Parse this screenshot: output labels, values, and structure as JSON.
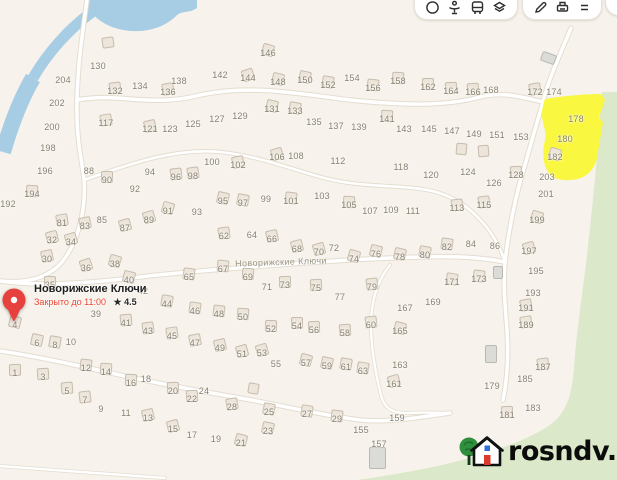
{
  "colors": {
    "bg": "#f7f3ec",
    "water": "#a6cde4",
    "forest": "#dbe8c9",
    "yellow": "#f9f73f",
    "road": "#ffffff",
    "road_casing": "#e4ddd0",
    "house_fill": "#ede5d9",
    "house_border": "#c6bcae",
    "gray_fill": "#dbdbd8",
    "gray_border": "#b9b9b4",
    "label": "#87806f",
    "street_label": "#9d9687",
    "pin": "#e7413e",
    "status": "#ee4330",
    "icon": "#2e2e2e"
  },
  "toolbar": {
    "groups": [
      {
        "buttons": [
          {
            "icon": "traffic"
          },
          {
            "icon": "pedestrian"
          },
          {
            "icon": "bus"
          },
          {
            "icon": "layers"
          }
        ]
      },
      {
        "buttons": [
          {
            "icon": "measure"
          },
          {
            "icon": "print"
          },
          {
            "icon": "menu"
          }
        ]
      }
    ]
  },
  "place_popup": {
    "title": "Новорижские Ключи",
    "status": "Закрыто до 11:00",
    "rating_star": "★",
    "rating": "4.5"
  },
  "street_label": "Новорижские Ключи",
  "watermark": {
    "text": "rosndv.ru"
  },
  "highlighted_plots": [
    178,
    180,
    182
  ],
  "plots": {
    "format": "[plot_number, x, y, has_house]",
    "items": [
      [
        130,
        98,
        66,
        0
      ],
      [
        204,
        63,
        80,
        0
      ],
      [
        202,
        57,
        103,
        0
      ],
      [
        200,
        52,
        127,
        0
      ],
      [
        198,
        48,
        148,
        0
      ],
      [
        196,
        45,
        171,
        0
      ],
      [
        194,
        32,
        194,
        1
      ],
      [
        192,
        8,
        204,
        0
      ],
      [
        132,
        115,
        91,
        1
      ],
      [
        134,
        140,
        86,
        0
      ],
      [
        136,
        168,
        92,
        1
      ],
      [
        138,
        179,
        81,
        0
      ],
      [
        117,
        106,
        123,
        1
      ],
      [
        121,
        150,
        129,
        1
      ],
      [
        123,
        170,
        129,
        0
      ],
      [
        125,
        193,
        124,
        0
      ],
      [
        88,
        89,
        171,
        0
      ],
      [
        90,
        107,
        180,
        1
      ],
      [
        92,
        135,
        189,
        0
      ],
      [
        94,
        150,
        172,
        0
      ],
      [
        96,
        176,
        177,
        1
      ],
      [
        98,
        193,
        176,
        1
      ],
      [
        146,
        268,
        53,
        1
      ],
      [
        142,
        220,
        75,
        0
      ],
      [
        144,
        248,
        78,
        1
      ],
      [
        148,
        278,
        82,
        1
      ],
      [
        150,
        305,
        80,
        1
      ],
      [
        152,
        328,
        85,
        1
      ],
      [
        154,
        352,
        78,
        0
      ],
      [
        156,
        373,
        88,
        1
      ],
      [
        158,
        398,
        81,
        1
      ],
      [
        162,
        428,
        87,
        1
      ],
      [
        164,
        451,
        91,
        1
      ],
      [
        166,
        473,
        92,
        1
      ],
      [
        168,
        491,
        90,
        0
      ],
      [
        172,
        535,
        92,
        1
      ],
      [
        174,
        554,
        92,
        0
      ],
      [
        127,
        217,
        119,
        0
      ],
      [
        129,
        240,
        116,
        0
      ],
      [
        131,
        272,
        109,
        1
      ],
      [
        133,
        295,
        111,
        1
      ],
      [
        135,
        314,
        122,
        0
      ],
      [
        137,
        336,
        126,
        0
      ],
      [
        139,
        359,
        127,
        0
      ],
      [
        141,
        387,
        119,
        1
      ],
      [
        143,
        404,
        129,
        0
      ],
      [
        145,
        429,
        129,
        0
      ],
      [
        147,
        452,
        131,
        0
      ],
      [
        149,
        474,
        134,
        0
      ],
      [
        151,
        497,
        135,
        0
      ],
      [
        153,
        521,
        137,
        0
      ],
      [
        100,
        212,
        162,
        0
      ],
      [
        102,
        238,
        165,
        1
      ],
      [
        106,
        277,
        157,
        1
      ],
      [
        108,
        296,
        156,
        0
      ],
      [
        112,
        338,
        161,
        0
      ],
      [
        118,
        401,
        167,
        0
      ],
      [
        120,
        431,
        175,
        0
      ],
      [
        124,
        468,
        172,
        0
      ],
      [
        126,
        494,
        183,
        0
      ],
      [
        128,
        516,
        175,
        1
      ],
      [
        203,
        547,
        177,
        0
      ],
      [
        178,
        576,
        119,
        0
      ],
      [
        180,
        565,
        139,
        0
      ],
      [
        182,
        555,
        157,
        1
      ],
      [
        201,
        546,
        194,
        0
      ],
      [
        199,
        537,
        220,
        1
      ],
      [
        197,
        529,
        251,
        1
      ],
      [
        195,
        536,
        271,
        0
      ],
      [
        193,
        533,
        293,
        0
      ],
      [
        191,
        526,
        308,
        1
      ],
      [
        189,
        526,
        325,
        1
      ],
      [
        111,
        413,
        211,
        0
      ],
      [
        113,
        457,
        208,
        1
      ],
      [
        115,
        484,
        205,
        1
      ],
      [
        80,
        425,
        255,
        1
      ],
      [
        82,
        447,
        247,
        1
      ],
      [
        84,
        471,
        244,
        0
      ],
      [
        86,
        495,
        246,
        0
      ],
      [
        171,
        452,
        282,
        1
      ],
      [
        173,
        479,
        279,
        1
      ],
      [
        169,
        433,
        302,
        0
      ],
      [
        167,
        405,
        308,
        0
      ],
      [
        165,
        400,
        331,
        1
      ],
      [
        163,
        400,
        365,
        0
      ],
      [
        161,
        394,
        384,
        1
      ],
      [
        159,
        397,
        418,
        0
      ],
      [
        155,
        361,
        430,
        0
      ],
      [
        157,
        379,
        444,
        0
      ],
      [
        185,
        525,
        379,
        0
      ],
      [
        187,
        543,
        367,
        1
      ],
      [
        183,
        533,
        408,
        0
      ],
      [
        181,
        507,
        415,
        1
      ],
      [
        179,
        492,
        386,
        0
      ],
      [
        95,
        223,
        201,
        1
      ],
      [
        97,
        243,
        203,
        1
      ],
      [
        99,
        266,
        199,
        0
      ],
      [
        101,
        291,
        201,
        1
      ],
      [
        103,
        322,
        196,
        0
      ],
      [
        105,
        349,
        205,
        1
      ],
      [
        107,
        370,
        211,
        0
      ],
      [
        109,
        391,
        210,
        0
      ],
      [
        62,
        224,
        236,
        1
      ],
      [
        64,
        252,
        235,
        0
      ],
      [
        66,
        272,
        239,
        1
      ],
      [
        68,
        297,
        249,
        1
      ],
      [
        70,
        319,
        252,
        1
      ],
      [
        72,
        334,
        248,
        0
      ],
      [
        74,
        354,
        259,
        1
      ],
      [
        76,
        376,
        254,
        1
      ],
      [
        78,
        400,
        257,
        1
      ],
      [
        67,
        223,
        269,
        1
      ],
      [
        69,
        248,
        277,
        1
      ],
      [
        71,
        267,
        287,
        0
      ],
      [
        73,
        285,
        285,
        1
      ],
      [
        75,
        316,
        288,
        1
      ],
      [
        77,
        340,
        297,
        0
      ],
      [
        79,
        372,
        287,
        1
      ],
      [
        81,
        62,
        223,
        1
      ],
      [
        83,
        85,
        226,
        1
      ],
      [
        85,
        102,
        220,
        0
      ],
      [
        87,
        125,
        228,
        1
      ],
      [
        89,
        149,
        220,
        1
      ],
      [
        91,
        168,
        211,
        1
      ],
      [
        93,
        197,
        212,
        0
      ],
      [
        32,
        52,
        240,
        1
      ],
      [
        34,
        71,
        242,
        1
      ],
      [
        30,
        47,
        259,
        1
      ],
      [
        36,
        86,
        268,
        1
      ],
      [
        38,
        115,
        264,
        1
      ],
      [
        40,
        129,
        280,
        1
      ],
      [
        42,
        143,
        291,
        0
      ],
      [
        44,
        167,
        304,
        1
      ],
      [
        46,
        195,
        311,
        1
      ],
      [
        65,
        189,
        277,
        1
      ],
      [
        35,
        50,
        285,
        1
      ],
      [
        39,
        96,
        314,
        0
      ],
      [
        41,
        126,
        323,
        1
      ],
      [
        43,
        148,
        331,
        1
      ],
      [
        45,
        172,
        336,
        1
      ],
      [
        47,
        195,
        343,
        1
      ],
      [
        48,
        219,
        314,
        1
      ],
      [
        50,
        243,
        317,
        1
      ],
      [
        52,
        271,
        329,
        1
      ],
      [
        54,
        297,
        326,
        1
      ],
      [
        56,
        314,
        330,
        1
      ],
      [
        58,
        345,
        333,
        1
      ],
      [
        60,
        371,
        325,
        1
      ],
      [
        49,
        220,
        348,
        1
      ],
      [
        51,
        242,
        354,
        1
      ],
      [
        53,
        262,
        353,
        1
      ],
      [
        55,
        276,
        364,
        0
      ],
      [
        57,
        306,
        363,
        1
      ],
      [
        59,
        327,
        366,
        1
      ],
      [
        61,
        346,
        367,
        1
      ],
      [
        63,
        363,
        371,
        1
      ],
      [
        4,
        15,
        325,
        1
      ],
      [
        6,
        37,
        343,
        1
      ],
      [
        8,
        55,
        345,
        1
      ],
      [
        10,
        71,
        342,
        0
      ],
      [
        1,
        15,
        373,
        1
      ],
      [
        3,
        43,
        377,
        1
      ],
      [
        5,
        67,
        391,
        1
      ],
      [
        7,
        85,
        400,
        1
      ],
      [
        9,
        101,
        409,
        0
      ],
      [
        11,
        126,
        413,
        0
      ],
      [
        12,
        86,
        368,
        1
      ],
      [
        14,
        106,
        372,
        1
      ],
      [
        16,
        131,
        383,
        1
      ],
      [
        18,
        146,
        379,
        0
      ],
      [
        20,
        173,
        391,
        1
      ],
      [
        22,
        192,
        399,
        1
      ],
      [
        24,
        204,
        391,
        0
      ],
      [
        13,
        148,
        418,
        1
      ],
      [
        15,
        173,
        429,
        1
      ],
      [
        17,
        192,
        435,
        0
      ],
      [
        19,
        216,
        439,
        0
      ],
      [
        21,
        241,
        443,
        1
      ],
      [
        23,
        268,
        431,
        1
      ],
      [
        25,
        269,
        412,
        1
      ],
      [
        27,
        307,
        414,
        1
      ],
      [
        29,
        337,
        419,
        1
      ],
      [
        28,
        232,
        407,
        1
      ]
    ]
  },
  "buildings": {
    "format": "[x, y, w, h, rot_deg, style]",
    "items": [
      [
        108,
        42,
        12,
        11,
        -8,
        "beige"
      ],
      [
        548,
        58,
        15,
        10,
        20,
        "gray"
      ],
      [
        461,
        149,
        11,
        12,
        5,
        "beige"
      ],
      [
        483,
        151,
        11,
        12,
        -5,
        "beige"
      ],
      [
        253,
        388,
        11,
        11,
        10,
        "beige"
      ],
      [
        498,
        272,
        10,
        13,
        0,
        "gray"
      ],
      [
        491,
        354,
        12,
        18,
        0,
        "gray"
      ],
      [
        377,
        458,
        17,
        22,
        0,
        "gray"
      ]
    ]
  }
}
